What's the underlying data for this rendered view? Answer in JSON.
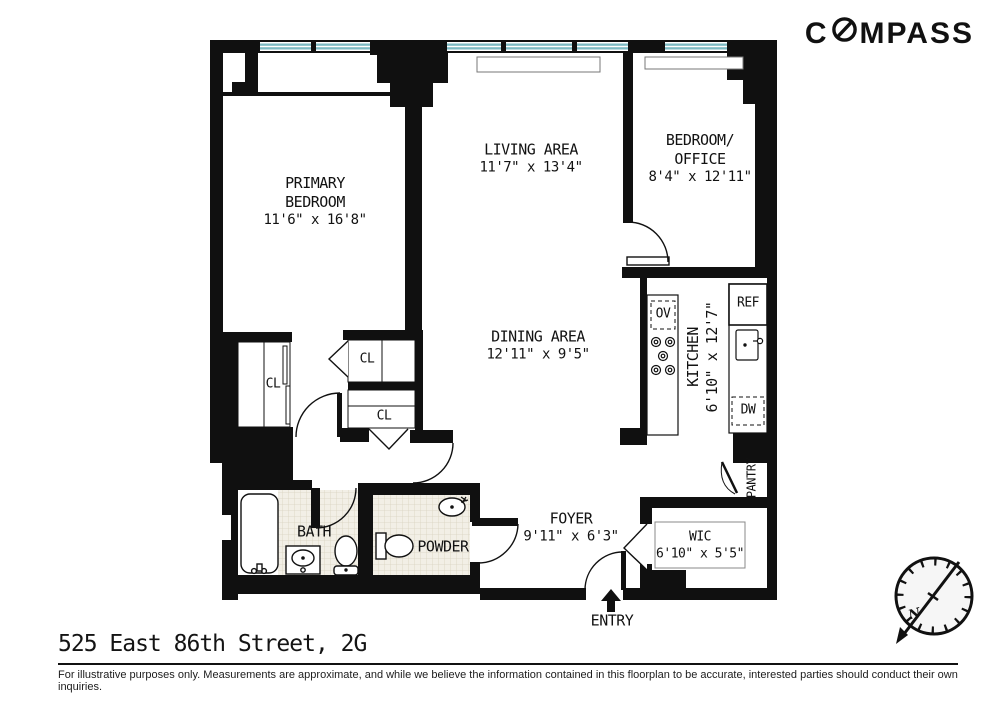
{
  "logo": {
    "first_letter": "C",
    "rest": "MPASS"
  },
  "rooms": {
    "primary_bedroom": {
      "name1": "PRIMARY",
      "name2": "BEDROOM",
      "dims": "11'6\" x 16'8\""
    },
    "living_area": {
      "name": "LIVING AREA",
      "dims": "11'7\" x 13'4\""
    },
    "bedroom_office": {
      "name1": "BEDROOM/",
      "name2": "OFFICE",
      "dims": "8'4\" x 12'11\""
    },
    "dining_area": {
      "name": "DINING AREA",
      "dims": "12'11\" x 9'5\""
    },
    "kitchen": {
      "name": "KITCHEN",
      "dims": "6'10\" x 12'7\""
    },
    "foyer": {
      "name": "FOYER",
      "dims": "9'11\" x 6'3\""
    },
    "wic": {
      "name": "WIC",
      "dims": "6'10\" x 5'5\""
    },
    "bath": {
      "name": "BATH"
    },
    "powder": {
      "name": "POWDER"
    },
    "pantry": {
      "name": "PANTRY"
    }
  },
  "closets": {
    "left": "CL",
    "hall_upper": "CL",
    "hall_lower": "CL"
  },
  "appliances": {
    "oven": "OV",
    "refrigerator": "REF",
    "dishwasher": "DW"
  },
  "entry": {
    "label": "ENTRY"
  },
  "compass_rose": {
    "north": "N"
  },
  "footer": {
    "address": "525 East 86th Street, 2G",
    "disclaimer": "For illustrative purposes only.  Measurements are approximate, and while we believe the information contained in this floorplan to be accurate, interested parties should conduct their own inquiries."
  },
  "colors": {
    "wall": "#101010",
    "window_glass": "#7cbac3",
    "tile": "#f2efe6",
    "logo": "#111111"
  }
}
